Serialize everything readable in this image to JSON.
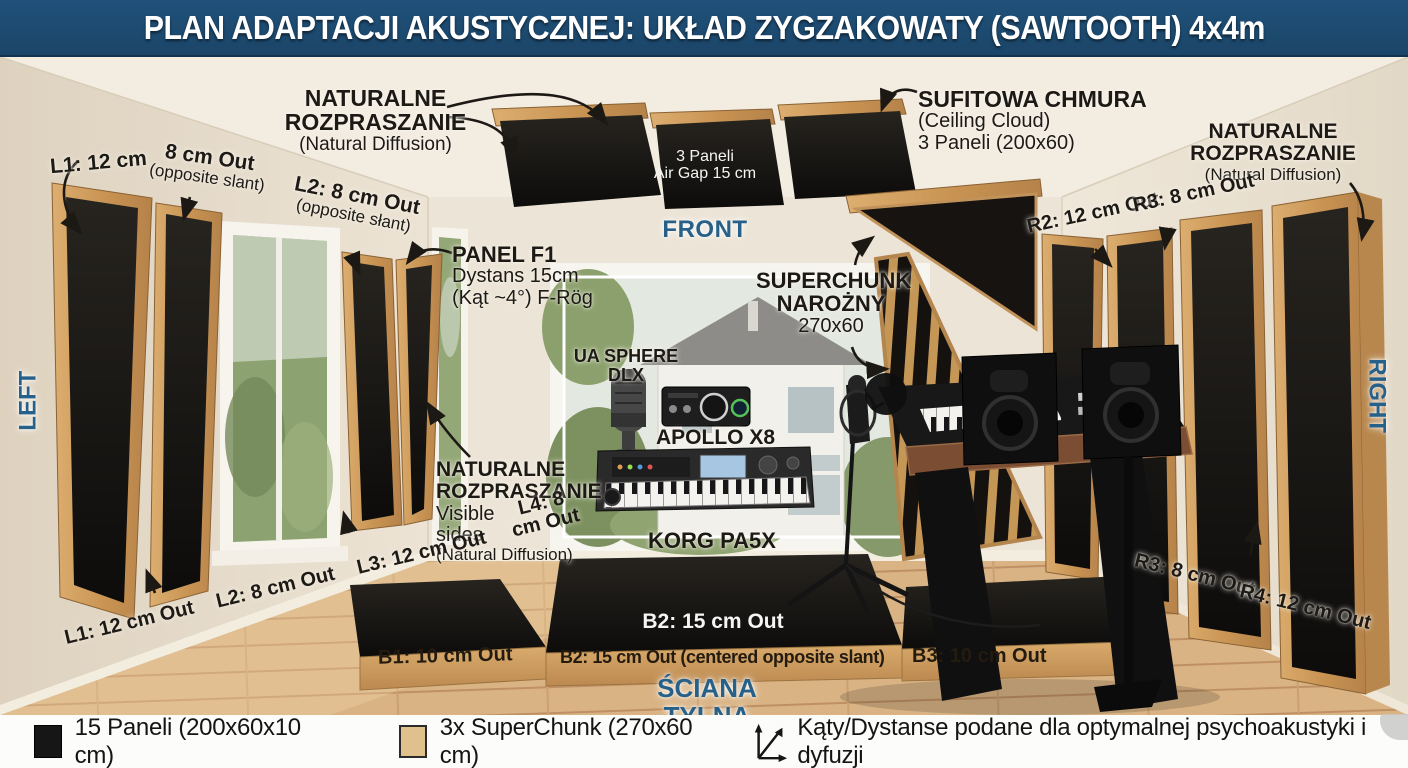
{
  "title": "PLAN ADAPTACJI AKUSTYCZNEJ: UKŁAD ZYGZAKOWATY (SAWTOOTH) 4x4m",
  "colors": {
    "title_bg": "#1d4a6e",
    "accent_blue": "#27618a",
    "wood": "#cf9f62",
    "panel_black": "#171514"
  },
  "orientation": {
    "left": "LEFT",
    "right": "RIGHT",
    "front": "FRONT",
    "back": "ŚCIANA TYLNA"
  },
  "annotations": {
    "diffusion_top_left": {
      "l1": "NATURALNE",
      "l2": "ROZPRASZANIE",
      "l3": "(Natural Diffusion)"
    },
    "ceiling_cloud": {
      "l1": "SUFITOWA CHMURA",
      "l2": "(Ceiling Cloud)",
      "l3": "3 Paneli (200x60)"
    },
    "diffusion_top_right": {
      "l1": "NATURALNE",
      "l2": "ROZPRASZANIE",
      "l3": "(Natural Diffusion)"
    },
    "ceiling_gap_note": {
      "l1": "3 Paneli",
      "l2": "Air Gap 15 cm"
    },
    "l1_height": "L1: 12 cm",
    "l1_offset": {
      "l1": "8 cm Out",
      "l2": "(opposite slant)"
    },
    "l2_offset": {
      "l1": "L2: 8 cm Out",
      "l2": "(opposite słant)"
    },
    "panel_f1": {
      "l1": "PANEL F1",
      "l2": "Dystans 15cm",
      "l3": "(Kąt ~4°) F-Rög"
    },
    "superchunk": {
      "l1": "SUPERCHUNK",
      "l2": "NAROŻNY",
      "l3": "270x60"
    },
    "diffusion_left_mid": {
      "l1": "NATURALNE",
      "l2": "ROZPRASZANIE",
      "l3": "Visible",
      "l4": "sides",
      "l5": "(Natural Diffusion)"
    },
    "left_bottom": {
      "l1": "L1: 12 cm Out",
      "l2": "L2: 8 cm Out",
      "l3": "L3: 12 cm Out",
      "l4": "L4: 8 cm Out"
    },
    "right_top": {
      "r2": "R2: 12 cm Out",
      "r3": "R3: 8 cm Out"
    },
    "right_bottom": {
      "r3": "R3: 8 cm Out",
      "r4": "R4: 12 cm Out"
    }
  },
  "equipment": {
    "mic": "UA SPHERE DLX",
    "audio_interface": "APOLLO X8",
    "keyboard": "KORG PA5X"
  },
  "bass_traps": {
    "b1": "B1: 10 cm Out",
    "b2_top": "B2: 15 cm Out",
    "b2_front": "B2: 15 cm Out (centered opposite slant)",
    "b3": "B3: 10 cm Out"
  },
  "legend": {
    "panels": "15 Paneli (200x60x10 cm)",
    "superchunk": "3x SuperChunk (270x60 cm)",
    "note": "Kąty/Dystanse podane dla optymalnej psychoakustyki i dyfuzji"
  }
}
